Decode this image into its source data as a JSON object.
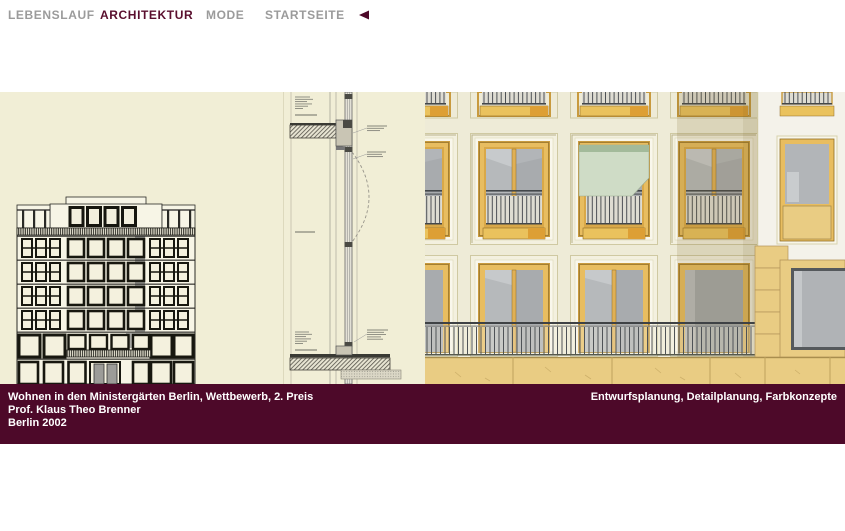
{
  "nav": {
    "items": [
      {
        "label": "LEBENSLAUF",
        "active": false
      },
      {
        "label": "ARCHITEKTUR",
        "active": true
      },
      {
        "label": "MODE",
        "active": false
      },
      {
        "label": "STARTSEITE",
        "active": false
      }
    ],
    "back_icon": "left-triangle"
  },
  "caption": {
    "project": "Wohnen in den Ministergärten Berlin, Wettbewerb, 2. Preis",
    "author": "Prof. Klaus Theo Brenner",
    "place_year": "Berlin 2002",
    "right": "Entwurfsplanung, Detailplanung, Farbkonzepte"
  },
  "colors": {
    "accent_maroon": "#4d0929",
    "nav_active": "#5a0f2e",
    "nav_inactive": "#9b9b9b",
    "panel_cream": "#f1eed6",
    "facade_wall": "#eeebd7",
    "facade_right_wall": "#f4f2ea",
    "window_frame_orange": "#e8bd60",
    "sandstone": "#e9cc83",
    "glass_gray": "#b4b7ba",
    "awning_green": "#cfdcc6"
  }
}
